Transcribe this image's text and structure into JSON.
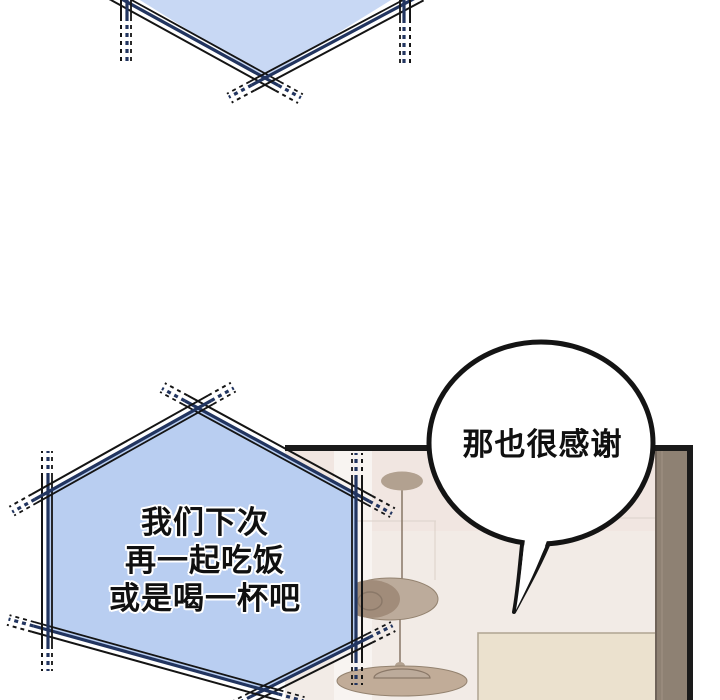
{
  "comic": {
    "type": "webtoon-panel",
    "speech_bubbles": {
      "top_partial": {
        "text": "",
        "fill": "#c8d8f4"
      },
      "invite": {
        "lines": [
          "我们下次",
          "再一起吃饭",
          "或是喝一杯吧"
        ],
        "fill": "#b9cef1",
        "border_navy": "#223560",
        "border_ink": "#141414"
      },
      "thanks": {
        "text": "那也很感谢",
        "fill": "#ffffff",
        "outline": "#141414"
      }
    },
    "panel": {
      "wall": "#f2ebe6",
      "wall_upper_tint": "#efe4df",
      "wall_light_band": "#f8f4f1",
      "frame": "#1a1a1a",
      "side_wood": "#8e8173",
      "side_wood_edge": "#6f6359",
      "side_wood_light": "#9c8e81",
      "bottom_canvas": "#ebe1ce",
      "bottom_canvas_edge": "#b3a896",
      "seam": "#ddd2ca",
      "lamp_cord": "#8d7d6d",
      "lamp_top": "#b2a190",
      "lamp_mid": "#bcab9b",
      "lamp_mid_dark": "#a18c7a",
      "lamp_bottom": "#c1ac98",
      "lamp_detail": "#8a7868"
    }
  }
}
